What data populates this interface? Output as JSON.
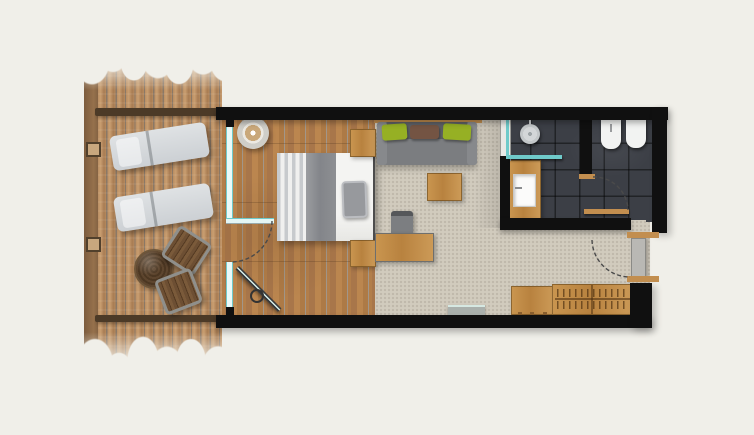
{
  "meta": {
    "type": "architectural floor plan",
    "view": "top-down render",
    "subject": "hotel room with terrace, bedroom-living area, bathroom, WC and entry"
  },
  "rooms": [
    {
      "name": "terrace",
      "floor": "wood decking",
      "items": [
        "sun-lounger",
        "sun-lounger",
        "round-side-table",
        "deck-chair",
        "deck-chair",
        "deck-railing",
        "railing-posts"
      ]
    },
    {
      "name": "bedroom-living",
      "floor": "oak planks and carpet",
      "items": [
        "double-bed",
        "bed-pillow",
        "nightstand",
        "nightstand",
        "pendant-lamp",
        "sofa",
        "green-cushion",
        "brown-cushion",
        "green-cushion",
        "wall-console",
        "coffee-table",
        "desk",
        "desk-chair",
        "tv-panel",
        "terrace-glass-door"
      ]
    },
    {
      "name": "bathroom",
      "floor": "dark slate tiles",
      "items": [
        "walk-in-shower",
        "shower-head",
        "glass-screen",
        "vanity-counter",
        "washbasin"
      ]
    },
    {
      "name": "wc",
      "floor": "dark slate tiles",
      "items": [
        "wall-hung-toilet",
        "bidet",
        "wc-door"
      ]
    },
    {
      "name": "entry",
      "floor": "carpet",
      "items": [
        "entrance-door",
        "wardrobe-cabinet",
        "coat-rack-section"
      ]
    }
  ],
  "doors": [
    {
      "name": "terrace-glass-door",
      "type": "hinged glass, shown open with swing arc"
    },
    {
      "name": "wc-door",
      "type": "hinged wood, shown open with swing arc"
    },
    {
      "name": "entrance-door",
      "type": "hinged, shown open with swing arc"
    }
  ],
  "colors": {
    "background": "#f0efe9",
    "wall": "#101010",
    "deck-wood": "#b5895f",
    "oak-floor": "#b07c49",
    "carpet": "#d1cbbe",
    "tile": "#3c3f46",
    "glass": "#6fcaca",
    "furniture-wood": "#c28e4f",
    "sofa-gray": "#75777a",
    "cushion-green": "#96b024",
    "cushion-brown": "#745443",
    "lounger-gray": "#d6d9dc",
    "fixture-white": "#f2f3f2",
    "door-gray": "#b9b8b4",
    "bed-white": "#f3f3f1",
    "bed-gray": "#898b8e"
  }
}
